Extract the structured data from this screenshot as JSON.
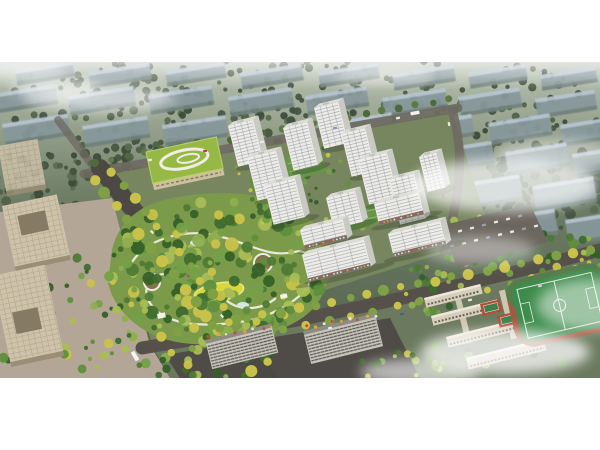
{
  "meta": {
    "description": "Aerial architectural rendering of a residential master plan: white high-rise towers, central landscaped park, kindergarten with green roof, offices, school campus with sports field, hazy existing city blocks behind",
    "canvas": {
      "width": 600,
      "height": 450
    },
    "image_area": {
      "x": 0,
      "y": 62,
      "width": 600,
      "height": 316
    }
  },
  "palette": {
    "page_bg": "#ffffff",
    "bg_top": "#b9c2b2",
    "bg_mid": "#6f7e66",
    "bg_bot": "#4f5e4a",
    "haze_roof": "#b6c5d2",
    "haze_face": "#87989c",
    "haze_shade": "#5f6f62",
    "road_dark": "#4c4843",
    "road_mid": "#55504a",
    "road_light": "#6e6a62",
    "dev_ground": "#77865f",
    "campus_ground": "#6b7a5f",
    "plaza_ground": "#b3a697",
    "asphalt": "#4f4b46",
    "park_base": "#7c9b4a",
    "path_white": "#f0ece2",
    "lawn": "#d9d73e",
    "lawn_edge": "#e9e783",
    "pond": "#d8e6e2",
    "tower_face": "#edece8",
    "tower_side": "#c9cac3",
    "tower_roof": "#dcdbd5",
    "stripe": "#a7abae",
    "mullion": "#9aa0a6",
    "retail": "#7b7168",
    "school_wall": "#e2d8b4",
    "school_wall_dark": "#cdc19b",
    "school_roof": "#96b845",
    "office_roof": "#cec2aa",
    "office_court": "#857a64",
    "office_grid": "#b0a489",
    "office_edge": "#9a8e76",
    "campus_bld": "#d7cebb",
    "campus_roof": "#eee7d7",
    "campus_win": "#6b6458",
    "corridor": "#cfc6b2",
    "court_red": "#b14f3a",
    "court_green": "#3f7f4a",
    "track_red": "#a05a42",
    "field_green": "#3e8c4d",
    "field_line": "#dfeadf",
    "apron": "#49824d",
    "parking": "#6b665e",
    "green_roof": "#68954a",
    "green_roof_line": "#93b964",
    "bslab_face": "#c6c3ba",
    "bslab_win": "#55524c",
    "bslab_roof": "#8e8b82",
    "shadow": "#2f3c2c",
    "mist": "#ffffff",
    "bg_greens": [
      "#3d4b3b",
      "#465741",
      "#50614a",
      "#5a6d52",
      "#435240"
    ],
    "park_greens": [
      "#3f6b2e",
      "#4e7a33",
      "#5f8f3d",
      "#74a047",
      "#8fae4e",
      "#a9bd55",
      "#c9c24a",
      "#356027"
    ],
    "row_colors": [
      "#c9c24a",
      "#7fa045"
    ],
    "dark_row_colors": [
      "#4e6a3a",
      "#5d7a42"
    ],
    "awnings": [
      "#c74a3a",
      "#d9a43a",
      "#e8e4da"
    ]
  },
  "scene": {
    "bg_slabs": [
      [
        15,
        70,
        58,
        16
      ],
      [
        88,
        72,
        62,
        17
      ],
      [
        165,
        71,
        60,
        16
      ],
      [
        240,
        73,
        62,
        17
      ],
      [
        318,
        72,
        60,
        16
      ],
      [
        392,
        74,
        62,
        17
      ],
      [
        468,
        73,
        58,
        16
      ],
      [
        540,
        75,
        56,
        16
      ],
      [
        -8,
        94,
        64,
        20
      ],
      [
        68,
        96,
        66,
        20
      ],
      [
        148,
        95,
        64,
        20
      ],
      [
        228,
        97,
        64,
        20
      ],
      [
        305,
        96,
        62,
        20
      ],
      [
        382,
        98,
        64,
        20
      ],
      [
        458,
        97,
        62,
        20
      ],
      [
        535,
        99,
        60,
        20
      ],
      [
        2,
        124,
        66,
        22
      ],
      [
        82,
        126,
        66,
        22
      ],
      [
        162,
        125,
        64,
        22
      ],
      [
        330,
        122,
        62,
        22
      ],
      [
        408,
        124,
        64,
        22
      ],
      [
        488,
        123,
        62,
        22
      ],
      [
        560,
        125,
        56,
        22
      ],
      [
        432,
        150,
        60,
        24
      ],
      [
        505,
        152,
        62,
        24
      ],
      [
        572,
        154,
        50,
        24
      ],
      [
        458,
        184,
        62,
        26
      ],
      [
        532,
        186,
        62,
        26
      ],
      [
        495,
        218,
        60,
        26
      ],
      [
        565,
        220,
        55,
        26
      ]
    ],
    "tree_clusters": [
      {
        "cx": 300,
        "cy": 88,
        "rx": 310,
        "ry": 30,
        "n": 150,
        "rmin": 2,
        "rmax": 4.5,
        "set": "bg"
      },
      {
        "cx": 300,
        "cy": 125,
        "rx": 310,
        "ry": 25,
        "n": 120,
        "rmin": 2,
        "rmax": 4.5,
        "set": "bg"
      },
      {
        "cx": 200,
        "cy": 158,
        "rx": 180,
        "ry": 22,
        "n": 80,
        "rmin": 2,
        "rmax": 5,
        "set": "bg"
      },
      {
        "cx": 520,
        "cy": 190,
        "rx": 95,
        "ry": 55,
        "n": 110,
        "rmin": 2,
        "rmax": 5.5,
        "set": "bg"
      },
      {
        "cx": 40,
        "cy": 185,
        "rx": 60,
        "ry": 35,
        "n": 40,
        "rmin": 2,
        "rmax": 5,
        "set": "bg"
      }
    ],
    "front_clusters": [
      {
        "cx": 218,
        "cy": 270,
        "rx": 108,
        "ry": 72,
        "n": 215,
        "rmin": 2.5,
        "rmax": 7,
        "set": "park"
      },
      {
        "cx": 318,
        "cy": 180,
        "rx": 85,
        "ry": 58,
        "n": 60,
        "rmin": 1.5,
        "rmax": 3.2,
        "set": "park"
      },
      {
        "cx": 545,
        "cy": 265,
        "rx": 80,
        "ry": 35,
        "n": 55,
        "rmin": 2,
        "rmax": 5,
        "set": "park"
      },
      {
        "cx": 430,
        "cy": 290,
        "rx": 35,
        "ry": 25,
        "n": 22,
        "rmin": 2,
        "rmax": 4,
        "set": "park"
      },
      {
        "cx": 80,
        "cy": 300,
        "rx": 72,
        "ry": 62,
        "n": 48,
        "rmin": 2,
        "rmax": 5,
        "set": "park"
      },
      {
        "cx": 470,
        "cy": 240,
        "rx": 40,
        "ry": 25,
        "n": 22,
        "rmin": 2,
        "rmax": 4,
        "set": "park"
      },
      {
        "cx": 300,
        "cy": 360,
        "rx": 300,
        "ry": 18,
        "n": 60,
        "rmin": 2,
        "rmax": 5,
        "set": "park"
      }
    ],
    "roads": [
      {
        "d": "M84,174 L458,108",
        "w": 9,
        "c": "road_light",
        "o": 0.9
      },
      {
        "d": "M452,110 C464,150 462,190 444,252",
        "w": 9,
        "c": "road_light",
        "o": 0.9
      },
      {
        "d": "M96,170 L58,120",
        "w": 8,
        "c": "road_light",
        "o": 0.75
      },
      {
        "d": "M100,168 L268,378",
        "w": 18,
        "c": "road_dark",
        "o": 1
      },
      {
        "d": "M142,348 C300,322 450,290 600,250",
        "w": 13,
        "c": "road_mid",
        "o": 1
      }
    ],
    "tree_rows": [
      {
        "x1": 94,
        "y1": 180,
        "x2": 252,
        "y2": 370,
        "n": 15,
        "r": 5,
        "set": "row"
      },
      {
        "x1": 112,
        "y1": 172,
        "x2": 268,
        "y2": 362,
        "n": 15,
        "r": 4.5,
        "set": "row"
      },
      {
        "x1": 160,
        "y1": 336,
        "x2": 590,
        "y2": 250,
        "n": 26,
        "r": 4.5,
        "set": "row"
      },
      {
        "x1": 170,
        "y1": 352,
        "x2": 600,
        "y2": 266,
        "n": 20,
        "r": 4,
        "set": "row"
      },
      {
        "x1": 95,
        "y1": 162,
        "x2": 450,
        "y2": 100,
        "n": 22,
        "r": 3.5,
        "set": "dark"
      }
    ],
    "awning_rows": [
      {
        "x1": 208,
        "y1": 336,
        "x2": 272,
        "y2": 326,
        "n": 8,
        "r": 1.5,
        "set": "awn"
      },
      {
        "x1": 306,
        "y1": 327,
        "x2": 376,
        "y2": 316,
        "n": 9,
        "r": 1.5,
        "set": "awn"
      }
    ],
    "ground": {
      "dev": "M100,176 L452,112 L492,238 L152,344 Z",
      "campus": "M152,346 L600,252 L600,378 L170,378 Z",
      "plaza": "M0,212 L112,198 L150,345 L170,378 L0,378 Z",
      "asphalt": "M165,355 L390,318 L420,378 L180,378 Z",
      "park": "M112,250 C118,222 140,205 168,199 C205,191 252,190 282,204 C312,216 332,236 330,262 C328,292 318,312 288,326 C255,342 205,350 168,340 C135,331 112,306 108,282 Z"
    },
    "park_paths": [
      "M132,262 C148,238 186,228 218,236 C252,244 268,258 294,252",
      "M294,252 C310,248 318,262 312,278 C304,300 270,318 240,322 C205,327 175,325 158,312 C146,302 142,288 152,280",
      "M152,280 C160,272 170,272 178,278",
      "M226,300 C240,312 262,310 276,298"
    ],
    "park_circle_paths": [
      {
        "cx": 152,
        "cy": 282,
        "r": 8
      },
      {
        "cx": 263,
        "cy": 263,
        "r": 9
      }
    ],
    "plaza_circles": [
      {
        "cx": 152,
        "cy": 282,
        "r": 7
      },
      {
        "cx": 263,
        "cy": 263,
        "r": 8
      }
    ],
    "lawn": {
      "cx": 219,
      "cy": 292,
      "rx": 25,
      "ry": 9,
      "rot": -10
    },
    "ponds": [
      {
        "cx": 197,
        "cy": 243,
        "rx": 7,
        "ry": 3.5
      },
      {
        "cx": 243,
        "cy": 305,
        "rx": 6,
        "ry": 3
      }
    ],
    "pavilions": [
      [
        157,
        314,
        8,
        5
      ],
      [
        280,
        295,
        7,
        4
      ]
    ],
    "school": {
      "x": 146,
      "y": 152,
      "rot": -12,
      "w": 72,
      "h": 32
    },
    "green_roofs": [
      {
        "x": 282,
        "y": 158,
        "rot": -14,
        "w": 40,
        "h": 24
      },
      {
        "x": 336,
        "y": 212,
        "rot": -14,
        "w": 44,
        "h": 22
      }
    ],
    "towers": [
      [
        314,
        108,
        25,
        42
      ],
      [
        228,
        126,
        26,
        42
      ],
      [
        283,
        128,
        25,
        44
      ],
      [
        341,
        134,
        25,
        44
      ],
      [
        419,
        157,
        18,
        36
      ],
      [
        247,
        158,
        30,
        44
      ],
      [
        358,
        160,
        30,
        46
      ],
      [
        389,
        180,
        26,
        46
      ],
      [
        264,
        186,
        32,
        40
      ],
      [
        326,
        198,
        30,
        32
      ]
    ],
    "slabs": [
      [
        300,
        230,
        44,
        20
      ],
      [
        374,
        204,
        46,
        22
      ],
      [
        388,
        234,
        54,
        24
      ],
      [
        302,
        255,
        64,
        28
      ]
    ],
    "bottom_slabs": [
      [
        205,
        340,
        68,
        30
      ],
      [
        303,
        331,
        74,
        34
      ]
    ],
    "offices": [
      {
        "x": -2,
        "y": 146,
        "rot": -10,
        "w": 40,
        "h": 46,
        "o": 0.85,
        "court": null
      },
      {
        "x": 2,
        "y": 206,
        "rot": -12,
        "w": 56,
        "h": 62,
        "o": 1,
        "court": [
          13,
          13,
          28,
          20
        ]
      },
      {
        "x": -8,
        "y": 276,
        "rot": -12,
        "w": 54,
        "h": 88,
        "o": 1,
        "court": [
          12,
          40,
          26,
          22
        ]
      }
    ],
    "campus_buildings": [
      [
        424,
        298,
        58,
        10
      ],
      [
        431,
        316,
        68,
        10
      ],
      [
        446,
        337,
        76,
        11
      ],
      [
        466,
        358,
        80,
        12
      ]
    ],
    "corridors": [
      [
        455,
        299,
        6,
        46
      ],
      [
        499,
        291,
        6,
        50
      ]
    ],
    "courts": [
      {
        "x": 480,
        "y": 304,
        "rot": -13
      },
      {
        "x": 497,
        "y": 316,
        "rot": -13
      }
    ],
    "field": {
      "x": 510,
      "y": 286,
      "rot": -13,
      "w": 88,
      "h": 60
    },
    "parking": {
      "poly": "M440,226 L530,204 L548,242 L458,268 Z",
      "rows": [
        {
          "x1": 452,
          "y1": 246,
          "x2": 536,
          "y2": 226,
          "n": 8
        },
        {
          "x1": 448,
          "y1": 234,
          "x2": 520,
          "y2": 216,
          "n": 7
        }
      ]
    },
    "cars": [
      [
        150,
        160,
        -10,
        "#e9e9e7",
        4,
        2.2
      ],
      [
        205,
        151,
        -10,
        "#b8443a",
        4,
        2.2
      ],
      [
        262,
        142,
        -10,
        "#e9e9e7",
        4,
        2.2
      ],
      [
        335,
        128,
        -10,
        "#8d98a6",
        4,
        2.2
      ],
      [
        398,
        118,
        -10,
        "#e9e9e7",
        4,
        2.2
      ],
      [
        415,
        113,
        -10,
        "#f2f2f0",
        9,
        3.5
      ],
      [
        449,
        124,
        80,
        "#e9e9e7",
        4,
        2.2
      ],
      [
        443,
        196,
        82,
        "#b8443a",
        4,
        2.2
      ],
      [
        330,
        328,
        -12,
        "#e9e9e7",
        4,
        2.2
      ],
      [
        402,
        314,
        -13,
        "#4a5f82",
        4,
        2.2
      ],
      [
        470,
        300,
        -14,
        "#e9e9e7",
        4,
        2.2
      ],
      [
        540,
        286,
        -14,
        "#cfcecb",
        4,
        2.2
      ],
      [
        152,
        232,
        48,
        "#e9e9e7",
        4,
        2.2
      ],
      [
        188,
        276,
        48,
        "#a85a7a",
        4,
        2.2
      ],
      [
        222,
        316,
        48,
        "#e9e9e7",
        4,
        2.2
      ],
      [
        135,
        356,
        60,
        "#f4f4f2",
        10,
        4
      ]
    ],
    "mist": [
      [
        100,
        98,
        75,
        14,
        0.55
      ],
      [
        55,
        88,
        45,
        10,
        0.5
      ],
      [
        28,
        70,
        40,
        8,
        0.5
      ],
      [
        385,
        76,
        50,
        9,
        0.4
      ],
      [
        505,
        185,
        95,
        26,
        0.7
      ],
      [
        555,
        155,
        60,
        16,
        0.45
      ],
      [
        480,
        250,
        55,
        14,
        0.4
      ],
      [
        505,
        352,
        85,
        22,
        0.75
      ],
      [
        420,
        372,
        60,
        14,
        0.6
      ],
      [
        592,
        305,
        55,
        26,
        0.5
      ]
    ]
  }
}
